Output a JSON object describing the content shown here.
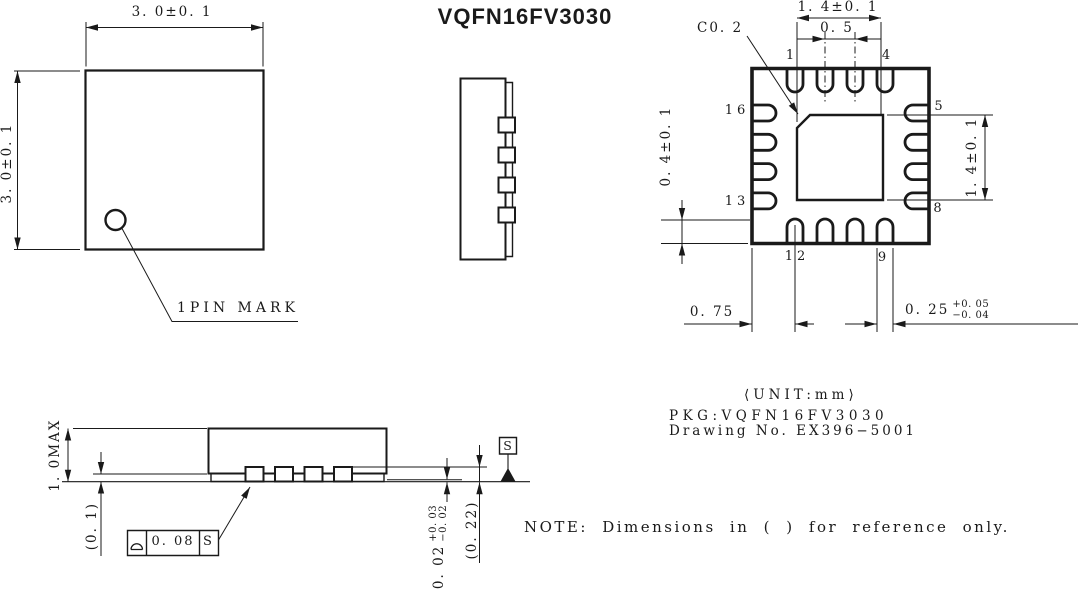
{
  "title": "VQFN16FV3030",
  "colors": {
    "ink": "#1a1a1a",
    "background": "#ffffff"
  },
  "top_view": {
    "width_dim": "3. 0±0. 1",
    "height_dim": "3. 0±0. 1",
    "pin_mark_label": "1PIN MARK"
  },
  "bottom_view": {
    "pad_width_dim": "1. 4±0. 1",
    "pitch_dim": "0. 5",
    "chamfer_dim": "C0. 2",
    "pad_height_dim": "1. 4±0. 1",
    "lead_length_dim": "0. 4±0. 1",
    "corner_to_lead_dim": "0. 75",
    "lead_width_dim": "0. 25",
    "lead_width_tol_plus": "+0. 05",
    "lead_width_tol_minus": "−0. 04",
    "pins": {
      "p1": "1",
      "p4": "4",
      "p5": "5",
      "p8": "8",
      "p9": "9",
      "p12": "12",
      "p13": "13",
      "p16": "16"
    }
  },
  "profile_view": {
    "height_dim": "1. 0MAX",
    "standoff_ref_dim": "(0. 1)",
    "standoff_dim": "0. 02",
    "standoff_tol_plus": "+0. 03",
    "standoff_tol_minus": "−0. 02",
    "lead_height_ref_dim": "(0. 22)",
    "coplanarity_value": "0. 08",
    "coplanarity_datum": "S",
    "datum_label": "S"
  },
  "info": {
    "unit": "⟨UNIT:mm⟩",
    "pkg": "PKG:VQFN16FV3030",
    "drawing_no": "Drawing No. EX396−5001",
    "note": "NOTE: Dimensions in ( ) for reference only."
  }
}
